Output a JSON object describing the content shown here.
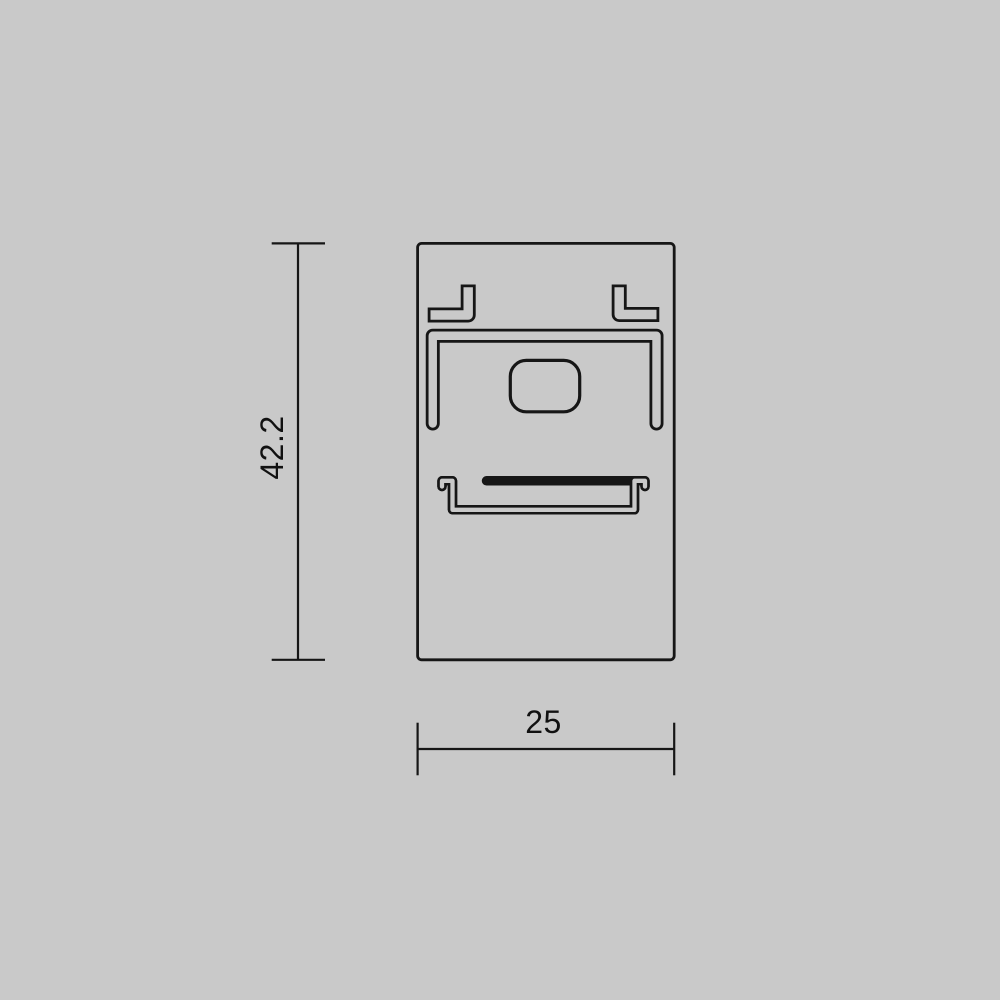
{
  "drawing": {
    "type": "technical-profile-cross-section",
    "dimension_height": {
      "label": "42.2"
    },
    "dimension_width": {
      "label": "25"
    }
  },
  "colors": {
    "background": "#c9c9c9",
    "line": "#161616",
    "text": "#111111"
  }
}
